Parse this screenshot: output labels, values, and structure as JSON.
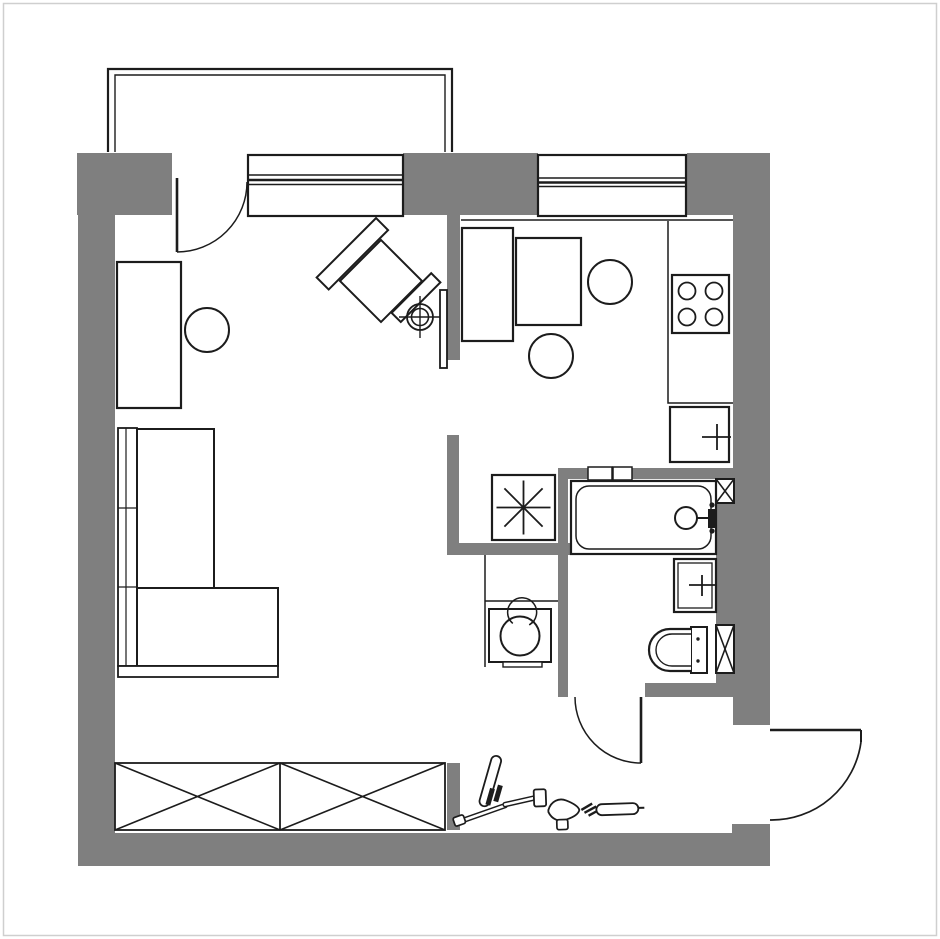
{
  "plan": {
    "type": "apartment-floor-plan",
    "title_hidden": "",
    "colors": {
      "background": "#ffffff",
      "wall": "#7f7f7f",
      "line": "#1c1c1c",
      "frame": "#cfcfcf",
      "fixture_fill": "#ffffff"
    },
    "rooms": [
      {
        "id": "balcony"
      },
      {
        "id": "living-room"
      },
      {
        "id": "kitchen"
      },
      {
        "id": "bathroom"
      },
      {
        "id": "hallway"
      },
      {
        "id": "entry"
      }
    ],
    "openings": [
      {
        "id": "balcony-door",
        "swing": "inward"
      },
      {
        "id": "bathroom-door",
        "swing": "outward-to-hall"
      },
      {
        "id": "entry-door",
        "swing": "outward"
      }
    ],
    "windows": [
      {
        "id": "living-room-window",
        "panes": 3
      },
      {
        "id": "kitchen-window",
        "panes": 3
      }
    ],
    "fixtures": [
      {
        "id": "balcony-rail"
      },
      {
        "id": "desk"
      },
      {
        "id": "desk-chair"
      },
      {
        "id": "corner-sofa",
        "sections": 2
      },
      {
        "id": "armchair",
        "rotation_deg": -45
      },
      {
        "id": "floor-lamp"
      },
      {
        "id": "tv"
      },
      {
        "id": "kitchen-cabinet"
      },
      {
        "id": "kitchen-table"
      },
      {
        "id": "kitchen-chair",
        "count": 2
      },
      {
        "id": "kitchen-counter"
      },
      {
        "id": "stove",
        "burners": 4
      },
      {
        "id": "kitchen-sink"
      },
      {
        "id": "water-heater-star",
        "rays": 8
      },
      {
        "id": "washing-machine"
      },
      {
        "id": "bathtub"
      },
      {
        "id": "bath-mixer"
      },
      {
        "id": "wash-basin"
      },
      {
        "id": "toilet"
      },
      {
        "id": "vent-shaft",
        "count": 2,
        "symbol": "x-brace"
      },
      {
        "id": "vent-grille",
        "count": 2
      },
      {
        "id": "wardrobe",
        "sections": 2,
        "symbol": "x-brace"
      },
      {
        "id": "bicycle"
      }
    ]
  }
}
